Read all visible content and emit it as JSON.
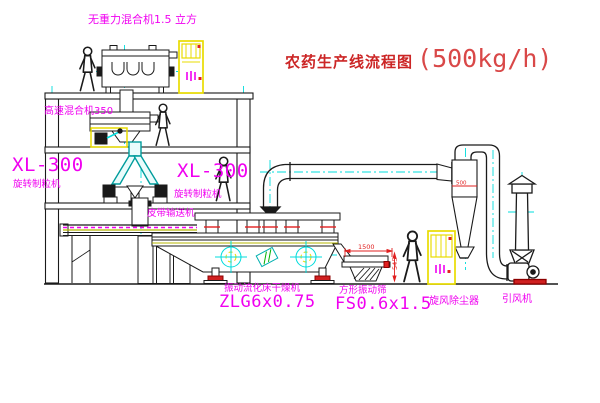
{
  "title": {
    "cn": "农药生产线流程图",
    "capacity": "(500kg/h)"
  },
  "labels": {
    "mixer_top": "无重力混合机1.5 立方",
    "mixer_mid": "高速混合机350",
    "granulator_left_model": "XL-300",
    "granulator_left_name": "旋转制粒机",
    "granulator_mid_model": "XL-300",
    "granulator_mid_name": "旋转制粒机",
    "belt_conveyor": "皮带输送机",
    "dryer_name": "振动流化床干燥机",
    "dryer_model": "ZLG6x0.75",
    "sieve_name": "方形振动筛",
    "sieve_model": "FS0.6x1.5",
    "cyclone": "旋风除尘器",
    "fan": "引风机"
  },
  "dimensions": {
    "sieve_width": "1500",
    "sieve_height": "545",
    "cyclone_dia": "500"
  },
  "colors": {
    "label_magenta": "#f000f0",
    "title_red": "#cc2626",
    "centerline_cyan": "#00dcdc",
    "cabinet_yellow": "#e8dc00",
    "dimension_red": "#e02020",
    "line_black": "#1a1a1a"
  }
}
